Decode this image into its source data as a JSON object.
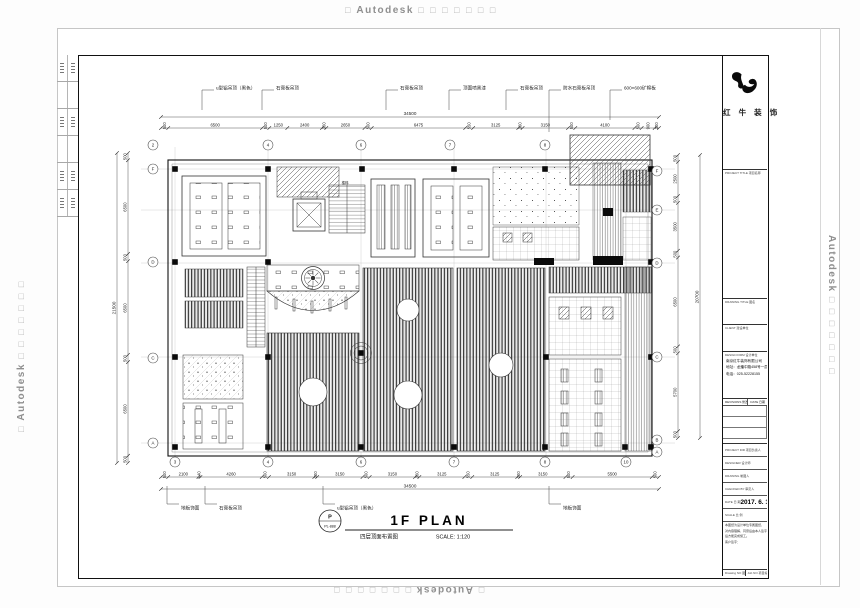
{
  "watermarks": {
    "prefix": "□",
    "brand": "Autodesk",
    "suffix": "□ □ □ □ □ □ □"
  },
  "plan": {
    "annotations_top": [
      {
        "text": "u型铝吊顶（黑色）",
        "x": 139
      },
      {
        "text": "石膏板吊顶",
        "x": 199
      },
      {
        "text": "石膏板吊顶",
        "x": 323
      },
      {
        "text": "顶面喷黑漆",
        "x": 386
      },
      {
        "text": "石膏板吊顶",
        "x": 443
      },
      {
        "text": "防水石膏板吊顶",
        "x": 486
      },
      {
        "text": "600×600矿棉板",
        "x": 547
      }
    ],
    "annotations_bottom": [
      {
        "text": "地板饰面",
        "x": 104
      },
      {
        "text": "石膏板吊顶",
        "x": 142
      },
      {
        "text": "u型铝吊顶（黑色）",
        "x": 260
      },
      {
        "text": "地板饰面",
        "x": 486
      }
    ],
    "room_labels": [
      {
        "text": "楼梯",
        "x": 266,
        "y": 129
      }
    ],
    "dims": {
      "top_total": "34500",
      "top_segments": [
        "500",
        "6500",
        "500",
        "1250",
        "2400",
        "300",
        "2650",
        "500",
        "6475",
        "550",
        "3125",
        "300",
        "3150",
        "500",
        "4100",
        "500",
        "900",
        "300"
      ],
      "bottom_total": "34500",
      "bottom_segments": [
        "500",
        "2100",
        "140",
        "4260",
        "500",
        "3150",
        "200",
        "3150",
        "500",
        "3150",
        "300",
        "3125",
        "550",
        "3125",
        "200",
        "3150",
        "500",
        "5500",
        "500"
      ],
      "left_total": "21500",
      "left_segments": [
        "500",
        "6500",
        "500",
        "6500",
        "500",
        "6500",
        "500"
      ],
      "right_total": "20700",
      "right_segments": [
        "500",
        "2500",
        "500",
        "3500",
        "500",
        "6500",
        "500",
        "5700",
        "500"
      ]
    },
    "grid": {
      "top": [
        {
          "n": "2",
          "x": 74
        },
        {
          "n": "4",
          "x": 189
        },
        {
          "n": "6",
          "x": 282
        },
        {
          "n": "7",
          "x": 371
        },
        {
          "n": "8",
          "x": 466
        }
      ],
      "bottom": [
        {
          "n": "3",
          "x": 96
        },
        {
          "n": "4",
          "x": 189
        },
        {
          "n": "6",
          "x": 282
        },
        {
          "n": "7",
          "x": 375
        },
        {
          "n": "8",
          "x": 466
        },
        {
          "n": "10",
          "x": 547
        }
      ],
      "left": [
        {
          "n": "F",
          "y": 114
        },
        {
          "n": "D",
          "y": 207
        },
        {
          "n": "C",
          "y": 303
        },
        {
          "n": "A",
          "y": 388
        }
      ],
      "right": [
        {
          "n": "F",
          "y": 116
        },
        {
          "n": "E",
          "y": 155
        },
        {
          "n": "D",
          "y": 208
        },
        {
          "n": "C",
          "y": 302
        },
        {
          "n": "B",
          "y": 385
        },
        {
          "n": "A",
          "y": 397
        }
      ]
    },
    "title": {
      "badge_top": "P",
      "badge_bottom": "PL-888",
      "main": "1F PLAN",
      "sub": "四层顶面布置图",
      "scale": "SCALE: 1:120"
    }
  },
  "titleblock": {
    "logo_text": "红 牛 装 饰",
    "sections": {
      "project_title": "PROJECT TITLE 项目名称",
      "drawing_title": "DRAWING TITLE 图名",
      "client": "CLIENT 建设单位",
      "design_firm": "DESIGN FIRM 设计单位"
    },
    "company": {
      "name": "南京红牛装饰有限公司",
      "address": "地址：龙蟠中路458号一层",
      "phone": "电话：025-52228155"
    },
    "revisions_header": {
      "left": "REVISIONS 修改",
      "right": "DATE 日期"
    },
    "fields": [
      {
        "label": "PROJECT DIR  项目负责人",
        "value": ""
      },
      {
        "label": "DESIGNER  设计师",
        "value": ""
      },
      {
        "label": "DRAWING  制图人",
        "value": ""
      },
      {
        "label": "CHECKED BY  审定人",
        "value": ""
      },
      {
        "label": "DATE  日 期",
        "value": "2017. 6. 11"
      },
      {
        "label": "SCALE  比 例",
        "value": ""
      }
    ],
    "note_lines": [
      "本图纸为设计单位专属图纸，",
      "对内容理解、同意后由本人签字",
      "后方能完成施工。",
      "客户签字："
    ],
    "footer": {
      "left": "Drawing NO 图号",
      "right": "Job NO 项目编号"
    }
  }
}
